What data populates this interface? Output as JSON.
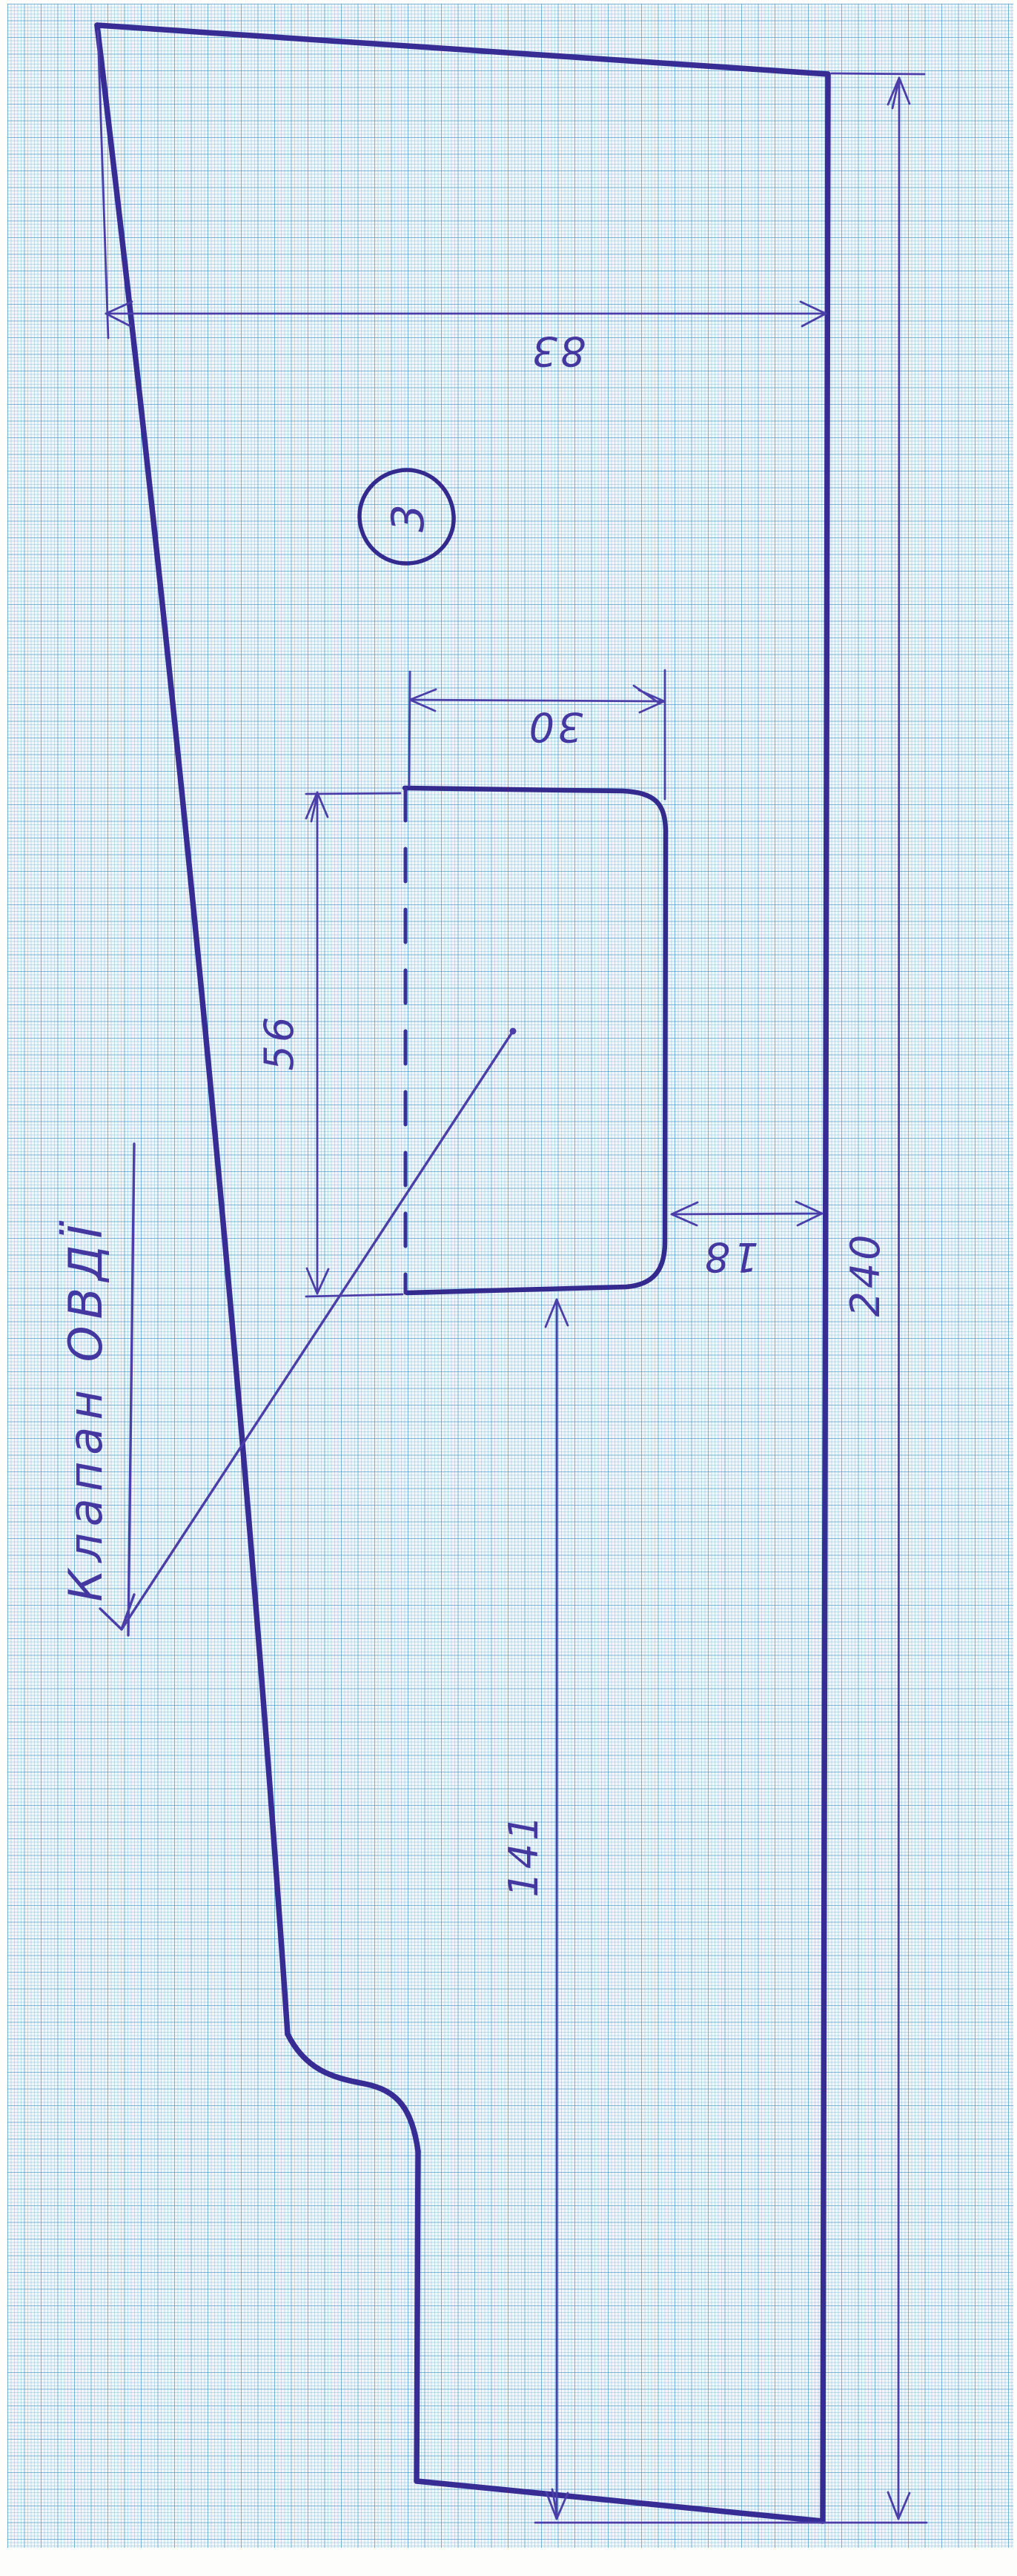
{
  "drawing": {
    "title": "Клапан ОВДЇ",
    "piece_number": "3",
    "dimensions": {
      "width_top": "83",
      "flap_width": "30",
      "flap_height": "56",
      "edge_offset": "18",
      "lower_length": "141",
      "overall_length": "240"
    },
    "colors": {
      "ink": "#372c94",
      "grid_line": "#78b9de",
      "paper": "#f3f7fa"
    }
  }
}
